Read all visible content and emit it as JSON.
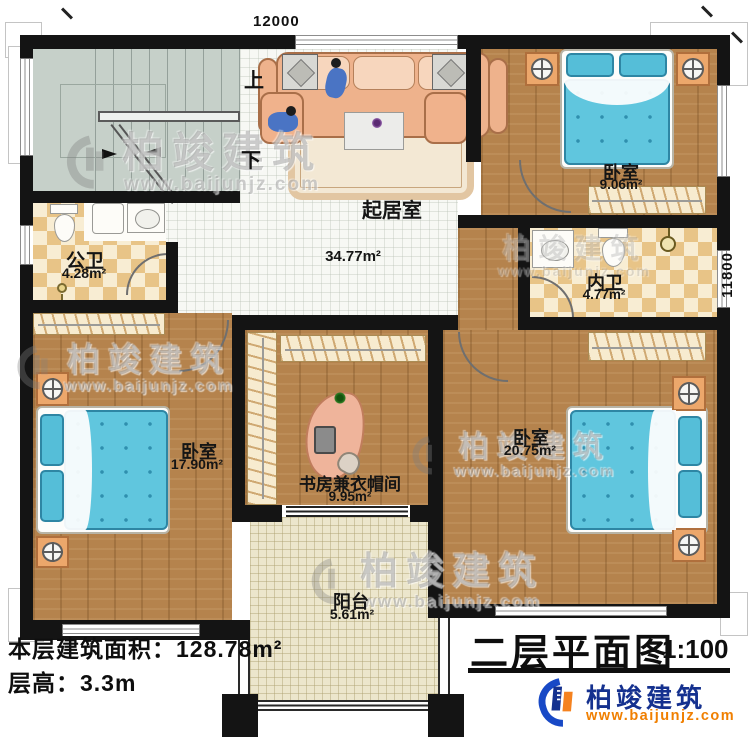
{
  "plan": {
    "dimensions": {
      "top": "12000",
      "right": "11800"
    },
    "stairs": {
      "up": "上",
      "down": "下"
    },
    "rooms": {
      "living": {
        "name": "起居室",
        "area": "34.77m²"
      },
      "bedroom_ne": {
        "name": "卧室",
        "area": "9.06m²"
      },
      "public_bath": {
        "name": "公卫",
        "area": "4.28m²"
      },
      "ensuite_bath": {
        "name": "内卫",
        "area": "4.77m²"
      },
      "bedroom_sw": {
        "name": "卧室",
        "area": "17.90m²"
      },
      "study_cloak": {
        "name": "书房兼衣帽间",
        "area": "9.95m²"
      },
      "bedroom_se": {
        "name": "卧室",
        "area": "20.75m²"
      },
      "balcony": {
        "name": "阳台",
        "area": "5.61m²"
      }
    }
  },
  "footer": {
    "floor_area_label": "本层建筑面积：",
    "floor_area_value": "128.78m²",
    "floor_height_label": "层高：",
    "floor_height_value": "3.3m"
  },
  "title_block": {
    "title": "二层平面图",
    "scale": "1:100"
  },
  "brand": {
    "name": "柏竣建筑",
    "url": "www.baijunjz.com"
  },
  "watermark": {
    "name": "柏竣建筑",
    "url": "www.baijunjz.com"
  },
  "colors": {
    "wall": "#141414",
    "wood": "#b5834d",
    "tile": "#f7f8f4",
    "checker": "#e8c487",
    "stairs": "#c6d0c9",
    "bed_blue": "#60c6de",
    "balcony": "#ece6cc",
    "brand_blue": "#15318f",
    "brand_orange": "#f07f00"
  }
}
